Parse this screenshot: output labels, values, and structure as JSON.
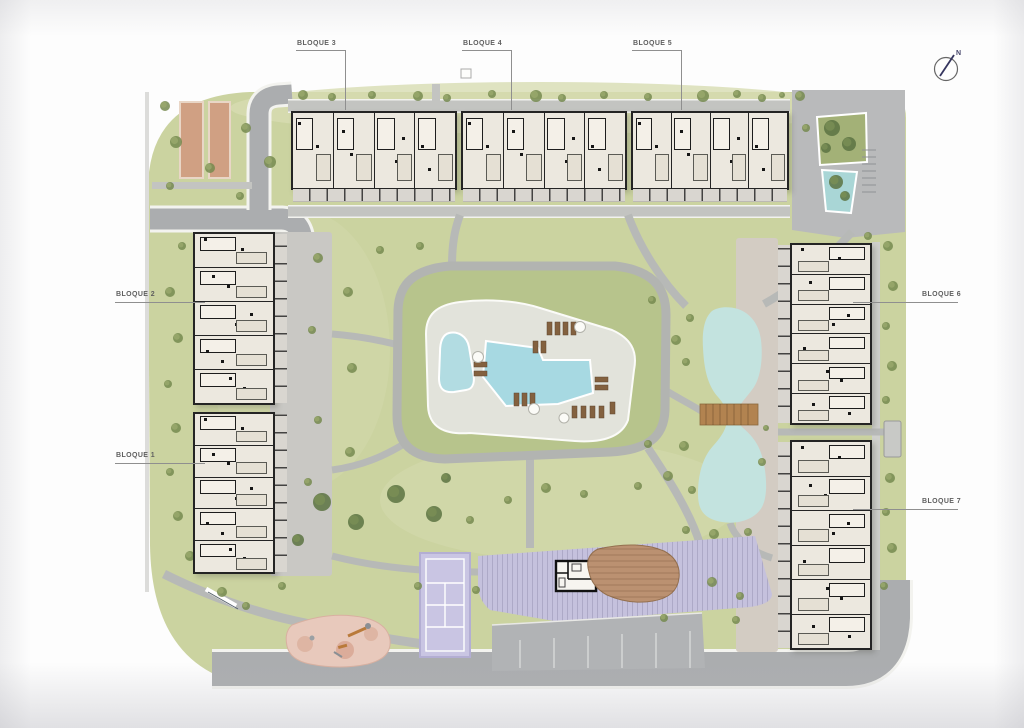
{
  "plan": {
    "blocks": [
      {
        "id": 1,
        "label": "BLOQUE 1"
      },
      {
        "id": 2,
        "label": "BLOQUE 2"
      },
      {
        "id": 3,
        "label": "BLOQUE 3"
      },
      {
        "id": 4,
        "label": "BLOQUE 4"
      },
      {
        "id": 5,
        "label": "BLOQUE 5"
      },
      {
        "id": 6,
        "label": "BLOQUE 6"
      },
      {
        "id": 7,
        "label": "BLOQUE 7"
      }
    ],
    "compass_north": "N"
  },
  "colors": {
    "grass": "#cbd3a0",
    "mound": "#b7c48c",
    "road": "#abadaf",
    "path": "#b7b9b7",
    "building": "#ece8df",
    "wall": "#242424",
    "terrace": "#d9d6d0",
    "pool": "#a7d9e2",
    "pond": "#c3e3df",
    "lavender": "#c5c1dd",
    "court": "#c9c5e3",
    "parking": "#b1b3b5",
    "playground": "#e8c9bc",
    "deck": "#bb9171",
    "sand_court": "#d0a083",
    "label_text": "#5f5f5f"
  }
}
